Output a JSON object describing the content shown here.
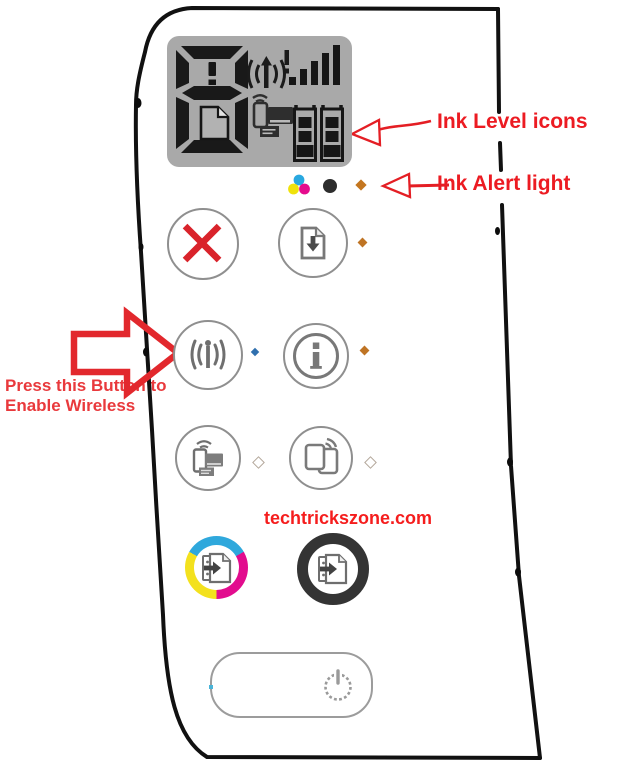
{
  "annotations": {
    "ink_level_label": "Ink Level icons",
    "ink_alert_label": "Ink Alert light",
    "wireless_note_line1": "Press this Button to",
    "wireless_note_line2": "Enable Wireless",
    "watermark": "techtrickszone.com"
  },
  "display": {
    "digit": "8",
    "digit_error_mark": "!",
    "page_icon": "page-icon",
    "wireless_status_icon": "wireless-alert-icon",
    "signal_bars_on": 5,
    "wifi_direct_icon": "wifi-direct-devices-icon",
    "ink_tanks": [
      {
        "name": "color-ink-level",
        "segments": 3
      },
      {
        "name": "black-ink-level",
        "segments": 3
      }
    ]
  },
  "status_lights": {
    "color_ink_icon": "tri-color-dots-icon",
    "black_ink_icon": "black-ink-dot-icon",
    "ink_alert_light": "#c4761f",
    "resume_light": "#bf7424",
    "wireless_light": "#2f6fae",
    "info_light": "#bf7424",
    "wifi_direct_light": "#b3a79a",
    "mobile_print_light": "#b3a79a",
    "power_light": "#49b4d8"
  },
  "buttons": {
    "cancel": {
      "icon": "cancel-x-icon"
    },
    "resume": {
      "icon": "resume-document-icon"
    },
    "wireless": {
      "icon": "wireless-antenna-icon"
    },
    "info": {
      "icon": "information-icon"
    },
    "wifi_direct": {
      "icon": "devices-wifi-icon"
    },
    "mobile_print": {
      "icon": "sheet-wifi-icon"
    },
    "color_copy": {
      "icon": "copy-document-icon",
      "ring_colors": [
        "#2fa8dc",
        "#e20c8e",
        "#f3e11e"
      ]
    },
    "black_copy": {
      "icon": "copy-document-icon",
      "ring_color": "#343434"
    },
    "power": {
      "icon": "power-icon"
    }
  },
  "colors": {
    "annotation_red": "#ec1b22",
    "arrow_red": "#e2282d",
    "lcd_background": "#a9a9a9",
    "panel_outline": "#111111"
  }
}
